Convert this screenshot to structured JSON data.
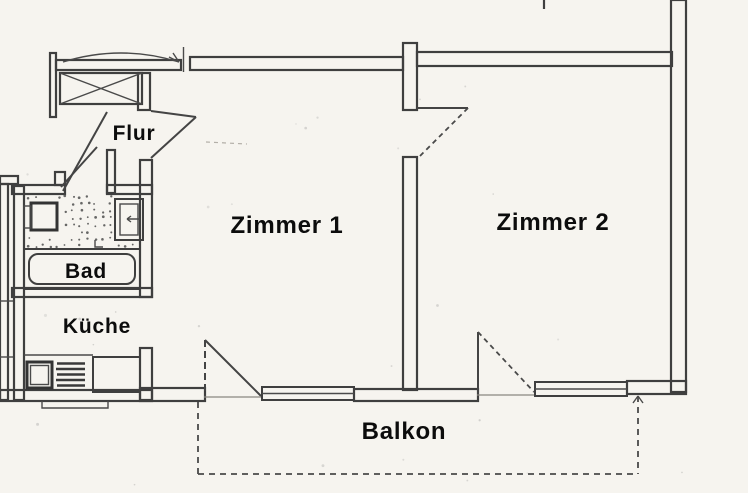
{
  "plan": {
    "kind_label": "apartment-floor-plan-scan",
    "rooms": {
      "flur": {
        "label": "Flur"
      },
      "bad": {
        "label": "Bad"
      },
      "kueche": {
        "label": "Küche"
      },
      "zimmer1": {
        "label": "Zimmer 1"
      },
      "zimmer2": {
        "label": "Zimmer 2"
      },
      "balkon": {
        "label": "Balkon"
      }
    },
    "fixtures": [
      "crossed-shaft-box",
      "entry-swing-arc",
      "wash-basin",
      "toilet",
      "bathtub",
      "kitchen-sink",
      "stove",
      "worktop",
      "balcony-door-zimmer1",
      "window-zimmer1",
      "balcony-door-zimmer2",
      "window-zimmer2",
      "balcony-dashed-outline",
      "interior-door-swings"
    ],
    "colors": {
      "paper": "#f6f4ef",
      "line": "#3f3f3f",
      "label_text": "#0c0c0c"
    }
  }
}
